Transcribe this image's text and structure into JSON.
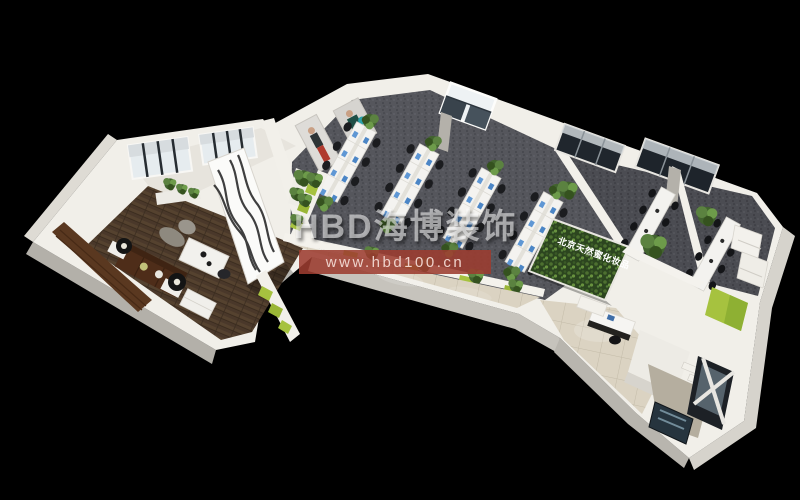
{
  "scene": {
    "type": "3d-interior-rendering",
    "subject": "isometric office floor plan",
    "background_color": "#000000"
  },
  "watermark": {
    "logo_text": "HBD海博装饰",
    "url_text": "www.hbd100.cn",
    "logo_color": "rgba(255,255,255,0.55)",
    "banner_color": "rgba(156,60,48,0.88)",
    "url_color": "#eed2cb"
  },
  "signage": {
    "logo_wall_text": "北京天然蜜化妆品",
    "logo_wall_text_color": "#ffffff"
  },
  "palette": {
    "walls": "#f1efe9",
    "wall_shadow": "#b3b0a9",
    "wood_floor": "#4a382a",
    "office_carpet": "#55565c",
    "meeting_carpet": "#4b4c52",
    "corridor_tile": "#dbd3c2",
    "accent_lime": "#a6c23f",
    "plant_wall_green": "#2c451f",
    "monitor_blue": "#4c86c6",
    "chair_black": "#1b1c1f",
    "sofa_brown": "#4e2d19"
  }
}
